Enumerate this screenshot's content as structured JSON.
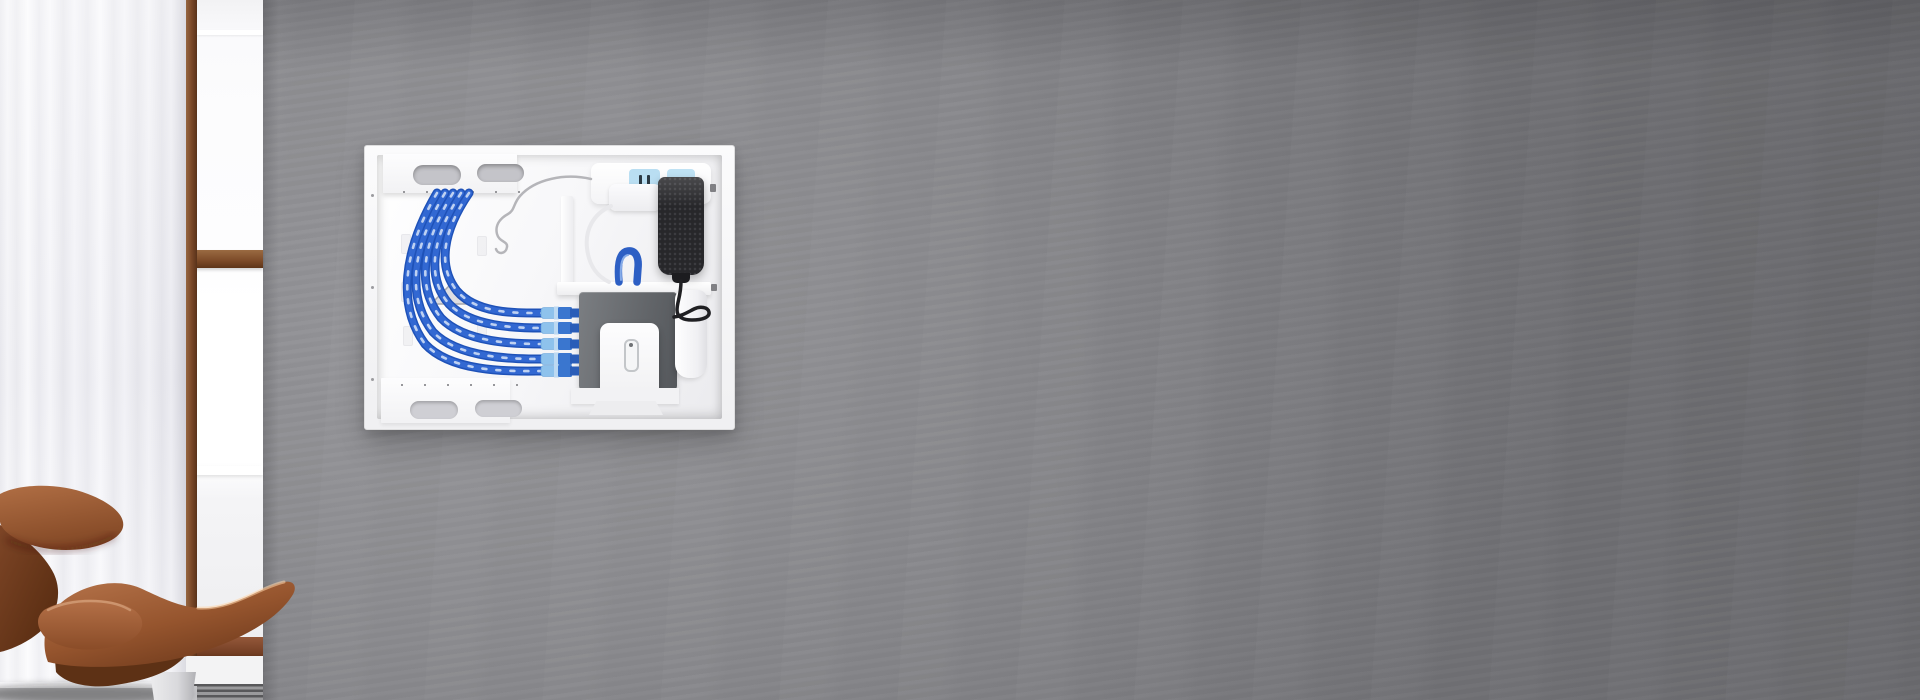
{
  "scene": {
    "description": "Living room photo: gray plaster wall with a recessed white in-wall media enclosure, sheer white curtain and wood-framed window on the left, cognac leather lounge chair in the foreground",
    "wall_color": "#8a8a8d",
    "window_frame_color": "#7a4828",
    "curtain_color": "#f4f4f8",
    "chair_leather_color": "#9c5c33",
    "floor_color": "#c6c6c9"
  },
  "enclosure": {
    "frame_color": "#f4f4f5",
    "interior_color": "#f7f7f9",
    "ethernet_cable_color": "#2f63c8",
    "ethernet_cable_count": 5,
    "patch_connector_count": 5,
    "bracket_cutout_count": 4,
    "outlet_receptacle_count": 2,
    "outlet_receptacle_color": "#b9def2",
    "power_adapter_color": "#27272a",
    "network_device_color": "#6b6e72",
    "device_cover_color": "#fafafb"
  },
  "labels": {
    "wall": "gray plaster wall",
    "curtain": "sheer white curtain",
    "window": "window with wood frame",
    "window_post": "wood window frame post",
    "mid_rail": "wood window mid rail",
    "bottom_rail": "wood window bottom rail",
    "baseboard": "white baseboard",
    "vent": "floor vent",
    "floor": "floor",
    "chair": "cognac leather lounge chair",
    "enclosure": "in-wall media enclosure",
    "interior": "enclosure interior",
    "top_bracket": "top cable-pass bracket",
    "bottom_bracket": "bottom cable-pass bracket",
    "divider": "white divider bracket",
    "shelf": "white equipment shelf",
    "outlet": "recessed power outlet module",
    "recept_left": "left blue receptacle",
    "recept_right": "right blue receptacle",
    "plug": "white power plug",
    "adapter": "black power adapter",
    "device": "gray network device",
    "cylinder": "white power supply",
    "ubracket": "white device cover bracket",
    "cables": "blue ethernet cables",
    "chair_art": "lounge chair illustration"
  }
}
